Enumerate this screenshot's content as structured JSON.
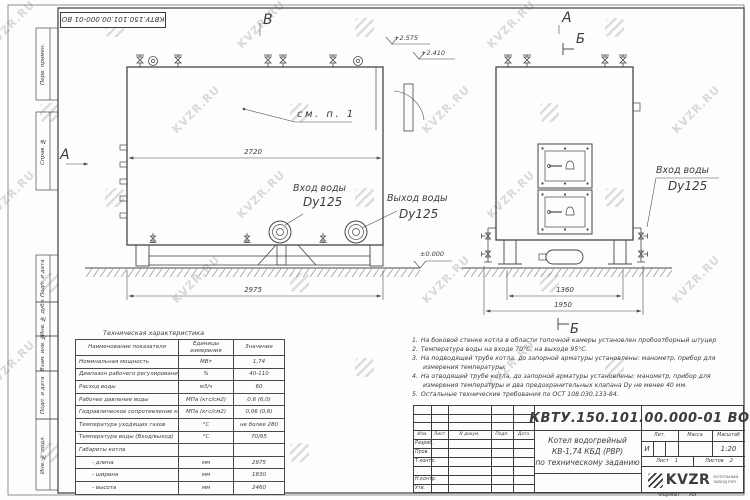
{
  "watermark": {
    "text": "KVZR.RU"
  },
  "margin_stamps": {
    "items": [
      {
        "label": "Перв. примен."
      },
      {
        "label": "Справ. №"
      },
      {
        "label": "Подп. и дата"
      },
      {
        "label": "Инв. № дубл."
      },
      {
        "label": "Взам. инв. №"
      },
      {
        "label": "Подп. и дата"
      },
      {
        "label": "Инв. № подл."
      }
    ]
  },
  "views": {
    "label_v_top": "В",
    "label_a_left": "А",
    "label_a_right": "А",
    "label_b_section_top": "Б",
    "label_b_section_bottom": "Б",
    "callout_see_note": "см. п. 1",
    "inlet_side": {
      "line1": "Вход воды",
      "line2": "Dy125"
    },
    "outlet_side": {
      "line1": "Выход воды",
      "line2": "Dy125"
    },
    "inlet_end": {
      "line1": "Вход воды",
      "line2": "Dy125"
    }
  },
  "dimensions": {
    "body_length": "2720",
    "overall_length": "2975",
    "base_width": "1360",
    "overall_width": "1950",
    "elev_top": "+2.575",
    "elev_mid": "+2.410",
    "elev_zero": "±0.000"
  },
  "tech_table": {
    "title": "Техническая характеристика",
    "headers": {
      "name": "Наименование показателя",
      "units": "Единицы измерения",
      "value": "Значение"
    },
    "rows": [
      {
        "name": "Номинальная мощность",
        "units": "МВт",
        "value": "1,74"
      },
      {
        "name": "Диапазон рабочего регулирования",
        "units": "%",
        "value": "40-110"
      },
      {
        "name": "Расход воды",
        "units": "м3/ч",
        "value": "60"
      },
      {
        "name": "Рабочее давление воды",
        "units": "МПа (кгс/см2)",
        "value": "0,6 (6,0)"
      },
      {
        "name": "Гидравлическое сопротивление котла",
        "units": "МПа (кгс/см2)",
        "value": "0,06 (0,6)"
      },
      {
        "name": "Температура уходящих газов",
        "units": "°С",
        "value": "не более 280"
      },
      {
        "name": "Температура воды (Вход/выход)",
        "units": "°С",
        "value": "70/95"
      },
      {
        "name": "Габариты котла",
        "units": "",
        "value": ""
      },
      {
        "name": "- длина",
        "units": "мм",
        "value": "2975"
      },
      {
        "name": "- ширина",
        "units": "мм",
        "value": "1830"
      },
      {
        "name": "- высота",
        "units": "мм",
        "value": "2460"
      }
    ]
  },
  "notes": {
    "items": [
      {
        "num": "1.",
        "text": "На боковой стенке котла в области топочной камеры установлен пробоотборный штуцер"
      },
      {
        "num": "2.",
        "text": "Температура воды на входе 70°С, на выходе 95°С."
      },
      {
        "num": "3.",
        "text": "На подводящей трубе котла, до запорной арматуры установлены: манометр, прибор для измерения температуры."
      },
      {
        "num": "4.",
        "text": "На отводящей трубе котла, до запорной арматуры установлены: манометр, прибор для измерения температуры и два предохранительных клапана Dу не менее 40 мм."
      },
      {
        "num": "5.",
        "text": "Остальные технические требования по ОСТ 108.030.133-84."
      }
    ]
  },
  "title_block": {
    "doc_number": "КВТУ.150.101.00.000-01 ВО",
    "title_line1": "Котел водогрейный",
    "title_line2": "КВ-1,74 КБД (РВР)",
    "title_line3": "по техническому заданию",
    "col_izm": "Изм.",
    "col_list": "Лист",
    "col_ndoc": "N докум.",
    "col_podp": "Подп.",
    "col_data": "Дата",
    "row_razrab": "Разраб.",
    "row_prov": "Пров.",
    "row_tkontr": "Т.контр.",
    "row_nkontr": "Н.контр.",
    "row_utv": "Утв.",
    "lit_label": "Лит.",
    "mass_label": "Масса",
    "scale_label": "Масштаб",
    "lit_value": "И",
    "scale_value": "1:20",
    "sheet_label": "Лист",
    "sheet_value": "1",
    "sheets_label": "Листов",
    "sheets_value": "2",
    "logo_text": "KVZR",
    "logo_sub1": "КОТЕЛЬНЫЙ",
    "logo_sub2": "ЗАВОД РЭП",
    "format_label": "Формат",
    "format_value": "А3"
  }
}
